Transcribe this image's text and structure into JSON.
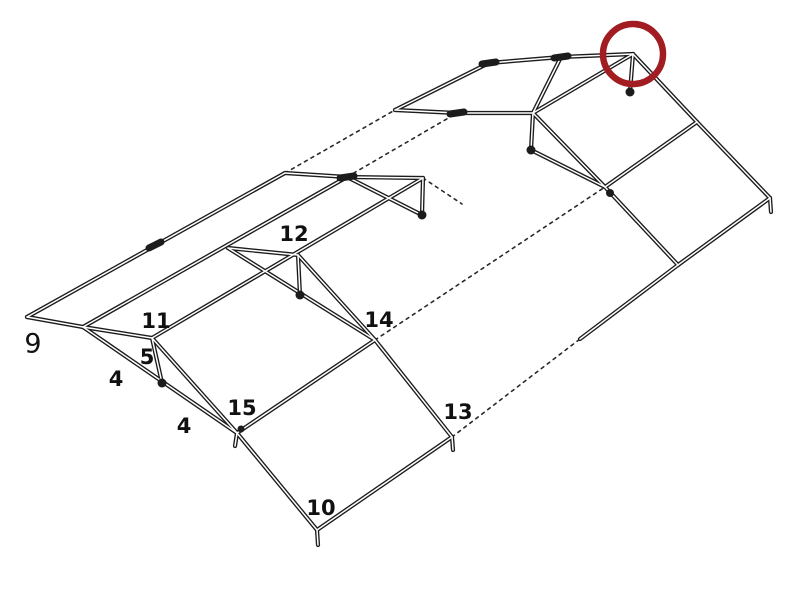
{
  "figure": {
    "background": "#ffffff",
    "line_color": "#1c1c1c",
    "line_width": 4.2,
    "core_color": "#ffffff",
    "core_width": 1.5,
    "dash_color": "#2a2a2a",
    "dash_width": 1.6,
    "dash_pattern": "3 4.5",
    "highlight_circle": {
      "cx": 633,
      "cy": 54,
      "r": 30,
      "stroke_width": 6.5,
      "color": "#a11d22"
    },
    "part_labels": [
      {
        "text": "9",
        "x": 33,
        "y": 344,
        "font_size": 27,
        "bold": false
      },
      {
        "text": "11",
        "x": 156,
        "y": 321,
        "font_size": 21,
        "bold": true
      },
      {
        "text": "5",
        "x": 147,
        "y": 357,
        "font_size": 21,
        "bold": true
      },
      {
        "text": "4",
        "x": 116,
        "y": 379,
        "font_size": 21,
        "bold": true
      },
      {
        "text": "4",
        "x": 184,
        "y": 426,
        "font_size": 21,
        "bold": true
      },
      {
        "text": "15",
        "x": 242,
        "y": 408,
        "font_size": 21,
        "bold": true
      },
      {
        "text": "12",
        "x": 294,
        "y": 234,
        "font_size": 21,
        "bold": true
      },
      {
        "text": "14",
        "x": 379,
        "y": 320,
        "font_size": 21,
        "bold": true
      },
      {
        "text": "13",
        "x": 458,
        "y": 412,
        "font_size": 21,
        "bold": true
      },
      {
        "text": "10",
        "x": 321,
        "y": 508,
        "font_size": 21,
        "bold": true
      }
    ],
    "solid_segments": [
      [
        27,
        317,
        285,
        173
      ],
      [
        285,
        173,
        347,
        177
      ],
      [
        347,
        177,
        423,
        178
      ],
      [
        83,
        327,
        347,
        177
      ],
      [
        27,
        317,
        83,
        327
      ],
      [
        83,
        327,
        237,
        433
      ],
      [
        152,
        338,
        162,
        383
      ],
      [
        83,
        327,
        152,
        338
      ],
      [
        152,
        338,
        237,
        433
      ],
      [
        152,
        338,
        423,
        178
      ],
      [
        228,
        248,
        298,
        255
      ],
      [
        228,
        248,
        375,
        340
      ],
      [
        298,
        255,
        300,
        295
      ],
      [
        298,
        255,
        375,
        340
      ],
      [
        423,
        178,
        422,
        215
      ],
      [
        347,
        177,
        422,
        215
      ],
      [
        237,
        433,
        317,
        530
      ],
      [
        317,
        530,
        452,
        437
      ],
      [
        375,
        340,
        452,
        437
      ],
      [
        237,
        433,
        375,
        340
      ],
      [
        489,
        63,
        561,
        57
      ],
      [
        561,
        57,
        633,
        54
      ],
      [
        633,
        54,
        533,
        113
      ],
      [
        633,
        54,
        697,
        122
      ],
      [
        633,
        54,
        630,
        92
      ],
      [
        457,
        113,
        533,
        113
      ],
      [
        533,
        113,
        531,
        150
      ],
      [
        531,
        150,
        605,
        187
      ],
      [
        533,
        113,
        605,
        187
      ],
      [
        489,
        63,
        395,
        110
      ],
      [
        395,
        110,
        457,
        113
      ],
      [
        605,
        187,
        697,
        122
      ],
      [
        605,
        187,
        678,
        265
      ],
      [
        697,
        122,
        770,
        198
      ],
      [
        770,
        198,
        678,
        265
      ],
      [
        678,
        265,
        580,
        339
      ],
      [
        561,
        57,
        533,
        113
      ],
      [
        317,
        530,
        318,
        545
      ],
      [
        452,
        437,
        453,
        450
      ],
      [
        237,
        433,
        235,
        446
      ],
      [
        770,
        198,
        771,
        212
      ]
    ],
    "dashed_segments": [
      [
        285,
        173,
        395,
        110
      ],
      [
        347,
        177,
        457,
        113
      ],
      [
        375,
        340,
        605,
        187
      ],
      [
        452,
        437,
        580,
        339
      ],
      [
        423,
        178,
        462,
        204
      ]
    ],
    "joint_dots": [
      [
        162,
        383,
        4.5
      ],
      [
        300,
        295,
        4.5
      ],
      [
        422,
        215,
        4.5
      ],
      [
        531,
        150,
        4.5
      ],
      [
        630,
        92,
        4.5
      ],
      [
        610,
        193,
        4.0
      ],
      [
        241,
        429,
        3.5
      ]
    ],
    "couplings": [
      [
        149,
        248,
        161,
        242
      ],
      [
        340,
        178,
        354,
        176
      ],
      [
        482,
        64,
        496,
        62
      ],
      [
        554,
        58,
        568,
        56
      ],
      [
        450,
        114,
        464,
        112
      ]
    ]
  }
}
